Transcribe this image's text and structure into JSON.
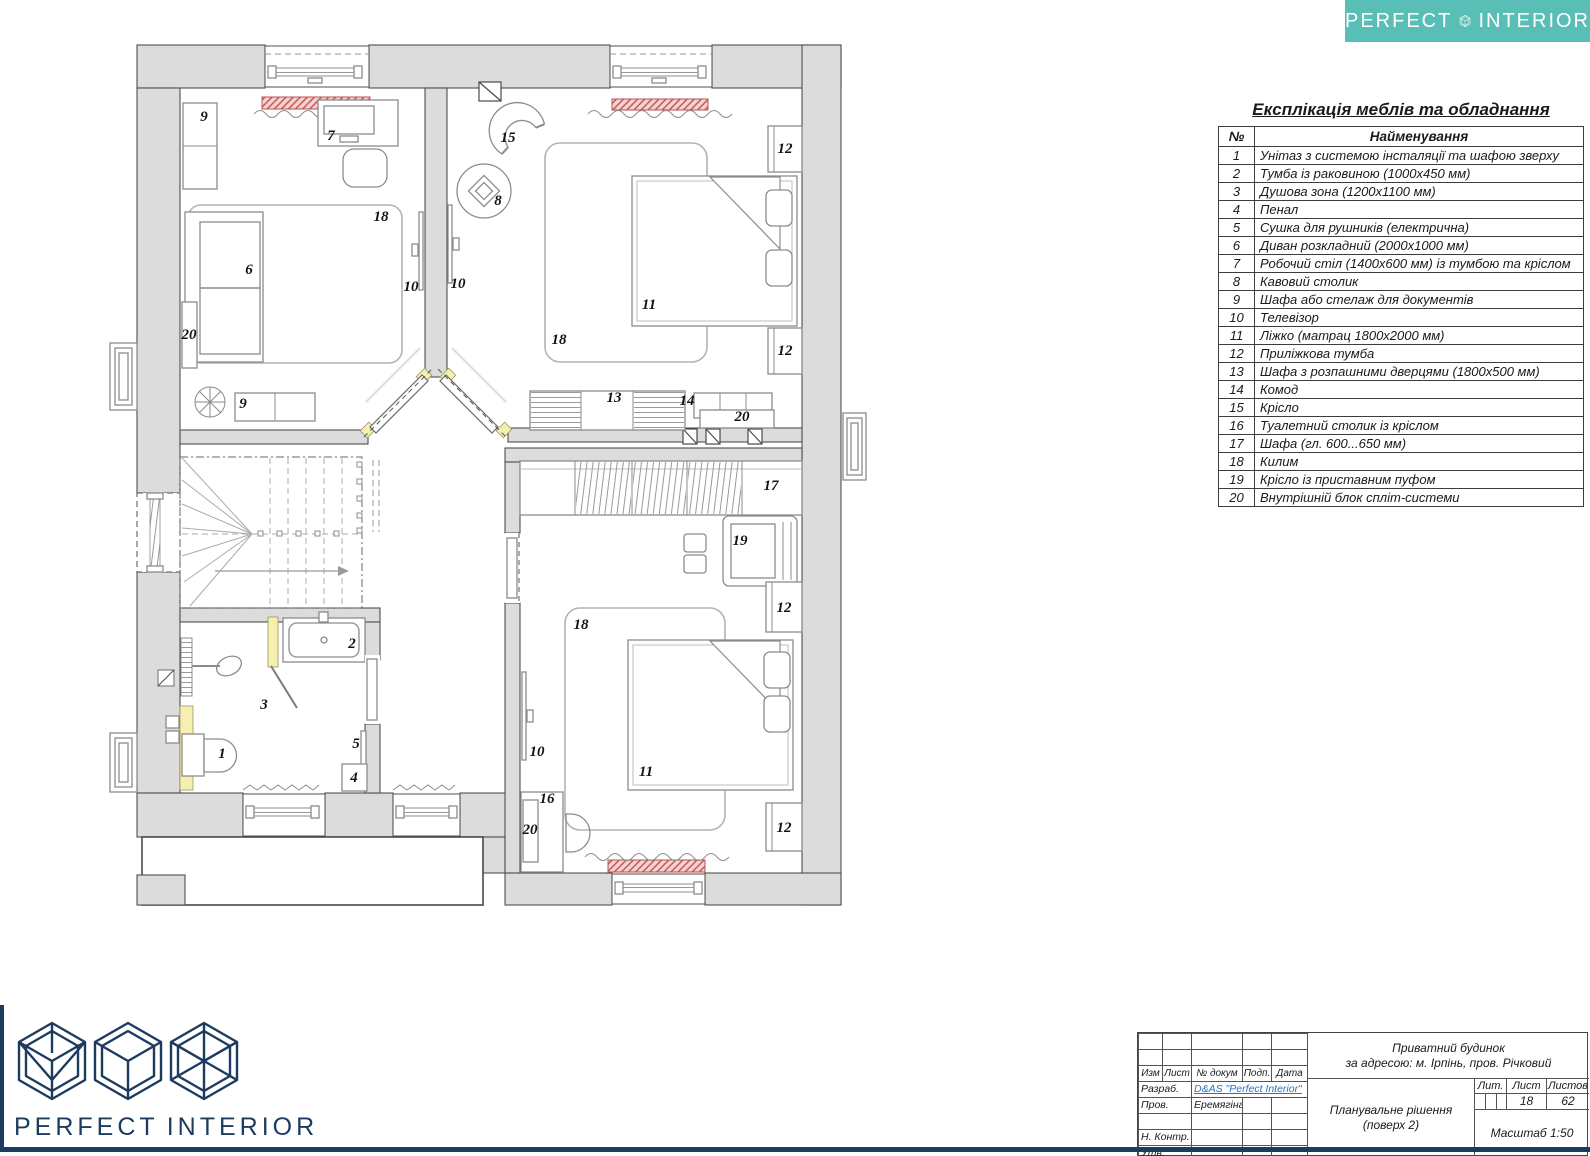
{
  "brand": {
    "word1": "PERFECT",
    "word2": "INTERIOR",
    "teal": "#59BFB6",
    "navy": "#1D3A5F",
    "link_blue": "#2176C7"
  },
  "legend": {
    "title": "Експлікація меблів та обладнання",
    "col_num": "№",
    "col_name": "Найменування",
    "rows": [
      {
        "n": "1",
        "name": "Унітаз з системою інсталяції та шафою зверху"
      },
      {
        "n": "2",
        "name": "Тумба із раковиною (1000х450 мм)"
      },
      {
        "n": "3",
        "name": "Душова зона (1200х1100 мм)"
      },
      {
        "n": "4",
        "name": "Пенал"
      },
      {
        "n": "5",
        "name": "Сушка для рушників (електрична)"
      },
      {
        "n": "6",
        "name": "Диван розкладний (2000х1000 мм)"
      },
      {
        "n": "7",
        "name": "Робочий стіл (1400х600 мм) із тумбою та кріслом"
      },
      {
        "n": "8",
        "name": "Кавовий столик"
      },
      {
        "n": "9",
        "name": "Шафа або стелаж для документів"
      },
      {
        "n": "10",
        "name": "Телевізор"
      },
      {
        "n": "11",
        "name": "Ліжко (матрац 1800х2000 мм)"
      },
      {
        "n": "12",
        "name": "Приліжкова тумба"
      },
      {
        "n": "13",
        "name": "Шафа з розпашними дверцями (1800х500 мм)"
      },
      {
        "n": "14",
        "name": "Комод"
      },
      {
        "n": "15",
        "name": "Крісло"
      },
      {
        "n": "16",
        "name": "Туалетний столик із кріслом"
      },
      {
        "n": "17",
        "name": "Шафа (гл. 600...650 мм)"
      },
      {
        "n": "18",
        "name": "Килим"
      },
      {
        "n": "19",
        "name": "Крісло із приставним пуфом"
      },
      {
        "n": "20",
        "name": "Внутрішній блок спліт-системи"
      }
    ]
  },
  "titleblock": {
    "cols": [
      "Изм",
      "Лист",
      "№ докум",
      "Подп.",
      "Дата"
    ],
    "rows": [
      {
        "label": "Разраб.",
        "value": "D&AS \"Perfect Interior\"",
        "span3": true,
        "link": true
      },
      {
        "label": "Пров.",
        "value": "Еремягіна І.О.",
        "span3": false,
        "link": false
      },
      {
        "label": "",
        "value": "",
        "span3": false,
        "link": false
      },
      {
        "label": "Н. Контр.",
        "value": "",
        "span3": false,
        "link": false
      },
      {
        "label": "Утв.",
        "value": "",
        "span3": false,
        "link": false
      }
    ],
    "project_line1": "Приватний будинок",
    "project_line2": "за адресою: м. Ірпінь, пров. Річковий",
    "doc_title_line1": "Планувальне рішення",
    "doc_title_line2": "(поверх 2)",
    "lit_label": "Лит.",
    "sheet_label": "Лист",
    "sheets_label": "Листов",
    "sheet": "18",
    "sheets": "62",
    "scale": "Масштаб 1:50"
  },
  "plan": {
    "labels": [
      {
        "t": "9",
        "x": 204,
        "y": 121
      },
      {
        "t": "7",
        "x": 331,
        "y": 140
      },
      {
        "t": "15",
        "x": 508,
        "y": 142
      },
      {
        "t": "12",
        "x": 785,
        "y": 153
      },
      {
        "t": "8",
        "x": 498,
        "y": 205
      },
      {
        "t": "18",
        "x": 381,
        "y": 221
      },
      {
        "t": "6",
        "x": 249,
        "y": 274
      },
      {
        "t": "10",
        "x": 411,
        "y": 291
      },
      {
        "t": "10",
        "x": 458,
        "y": 288
      },
      {
        "t": "11",
        "x": 649,
        "y": 309
      },
      {
        "t": "20",
        "x": 189,
        "y": 339
      },
      {
        "t": "18",
        "x": 559,
        "y": 344
      },
      {
        "t": "12",
        "x": 785,
        "y": 355
      },
      {
        "t": "13",
        "x": 614,
        "y": 402
      },
      {
        "t": "14",
        "x": 687,
        "y": 405
      },
      {
        "t": "9",
        "x": 243,
        "y": 408
      },
      {
        "t": "20",
        "x": 742,
        "y": 421
      },
      {
        "t": "17",
        "x": 771,
        "y": 490
      },
      {
        "t": "19",
        "x": 740,
        "y": 545
      },
      {
        "t": "12",
        "x": 784,
        "y": 612
      },
      {
        "t": "18",
        "x": 581,
        "y": 629
      },
      {
        "t": "2",
        "x": 352,
        "y": 648
      },
      {
        "t": "3",
        "x": 264,
        "y": 709
      },
      {
        "t": "10",
        "x": 537,
        "y": 756
      },
      {
        "t": "5",
        "x": 356,
        "y": 748
      },
      {
        "t": "1",
        "x": 222,
        "y": 758
      },
      {
        "t": "11",
        "x": 646,
        "y": 776
      },
      {
        "t": "4",
        "x": 354,
        "y": 782
      },
      {
        "t": "16",
        "x": 547,
        "y": 803
      },
      {
        "t": "12",
        "x": 784,
        "y": 832
      },
      {
        "t": "20",
        "x": 530,
        "y": 834
      }
    ]
  }
}
